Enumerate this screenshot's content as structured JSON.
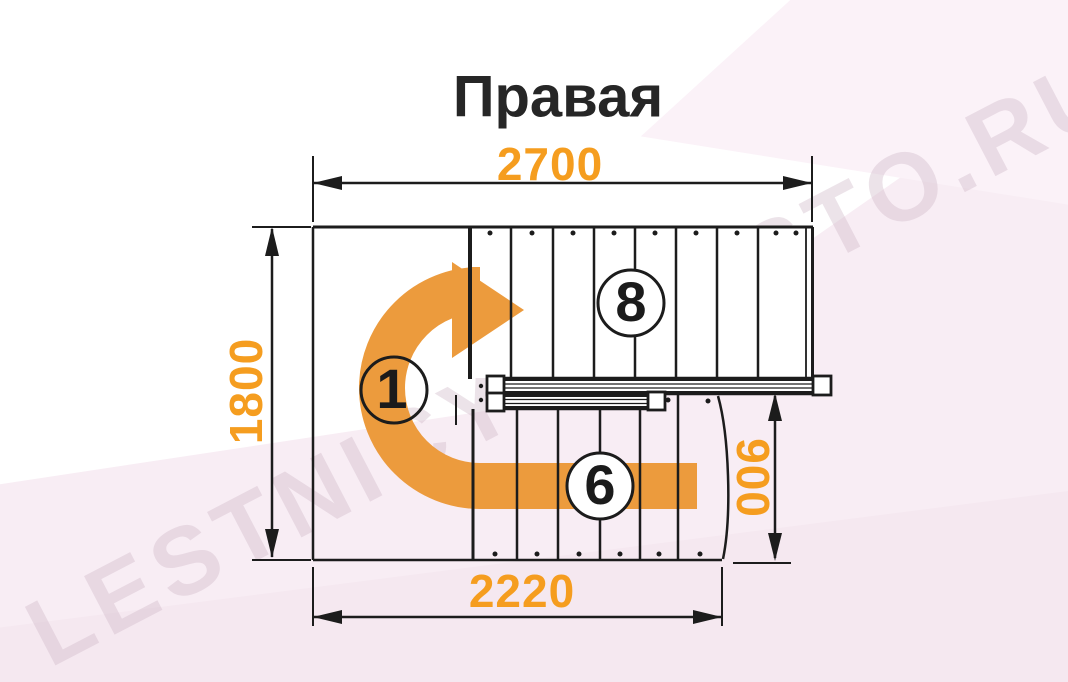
{
  "title": "Правая",
  "watermark": {
    "text": "LESTNICY-PROSTO.RU"
  },
  "dimensions": {
    "width_top": "2700",
    "height_left": "1800",
    "landing_width_right": "900",
    "width_bottom": "2220"
  },
  "step_labels": {
    "upper_flight": "8",
    "start": "1",
    "lower_flight": "6"
  },
  "colors": {
    "dimension_text": "#F59D1F",
    "arrow_orange": "#EC9B3D",
    "line": "#1C1C1C",
    "title_text": "#262626",
    "background_tint": "#F8EDF4"
  }
}
